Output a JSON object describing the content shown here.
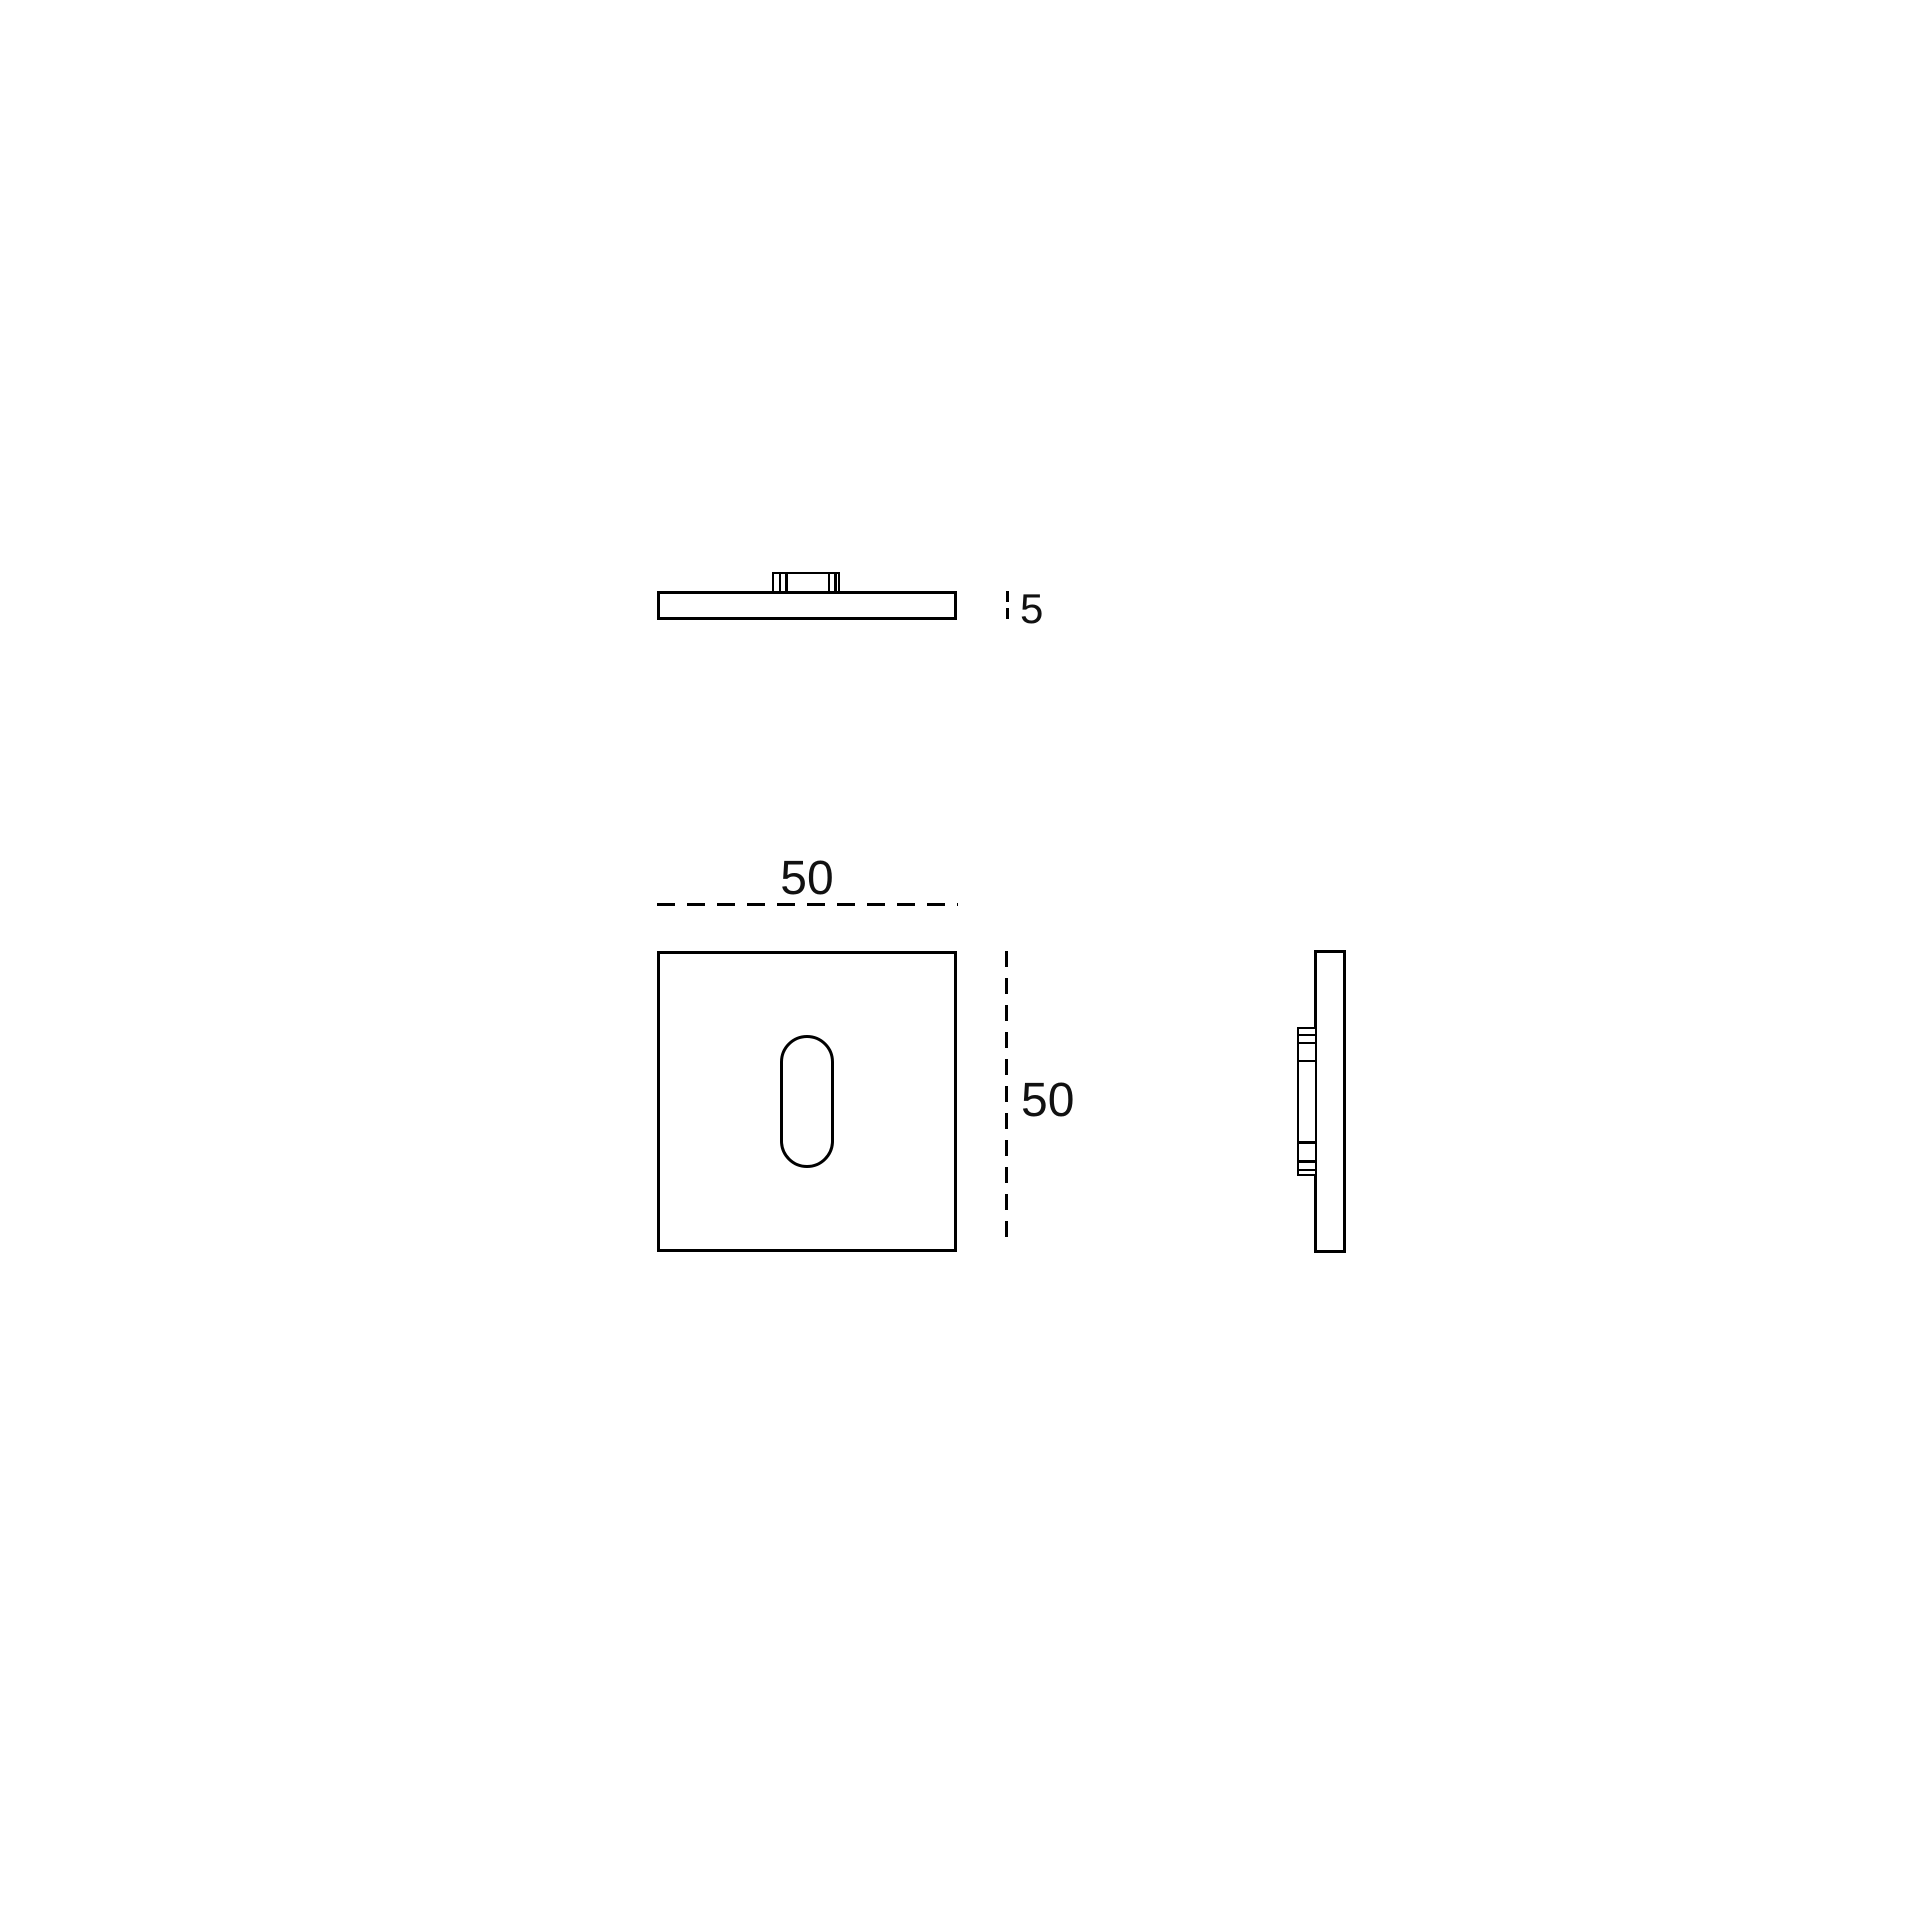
{
  "drawing": {
    "labels": {
      "thickness_mm": "5",
      "width_mm": "50",
      "height_mm": "50"
    },
    "colors": {
      "line": "#000000",
      "background": "#ffffff"
    }
  }
}
